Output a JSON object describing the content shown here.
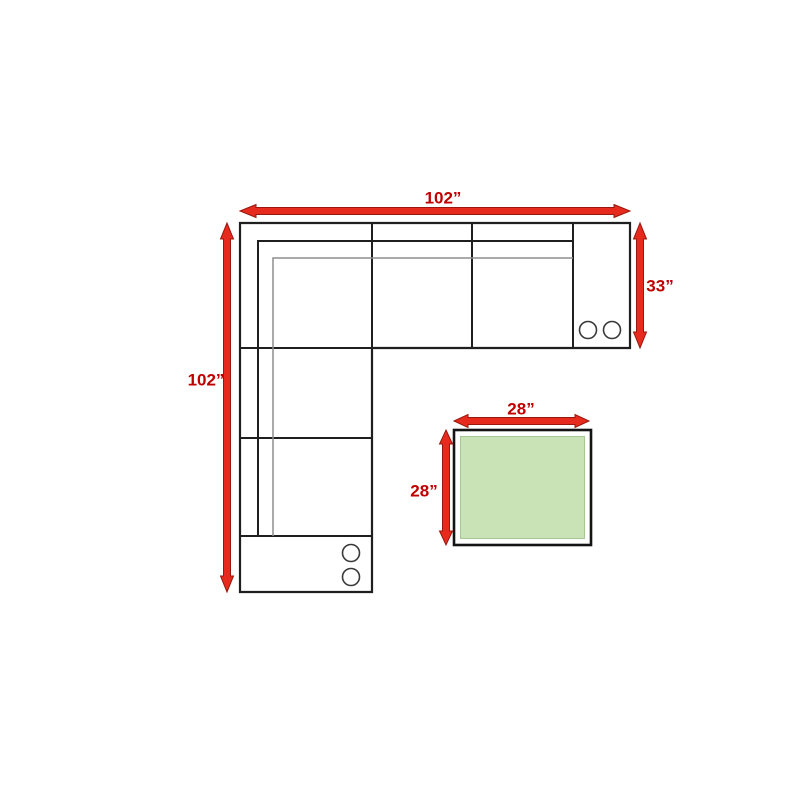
{
  "page": {
    "title": "Sectional sofa and ottoman dimension diagram",
    "background": "#ffffff"
  },
  "colors": {
    "arrow-red": "#e62b1e",
    "arrow-outline": "#9b170d",
    "label-red": "#c00000",
    "ottoman-green": "#c9e3b6",
    "ottoman-green-edge": "#a6c896",
    "line-black": "#1f1f1f",
    "line-gray": "#8e8e8e",
    "bg": "#ffffff"
  },
  "diagram": {
    "sofa": {
      "width_label": "102”",
      "depth_label": "102”",
      "right_section_depth_label": "33”",
      "cupholder_count": 4
    },
    "ottoman": {
      "width_label": "28”",
      "depth_label": "28”"
    }
  }
}
